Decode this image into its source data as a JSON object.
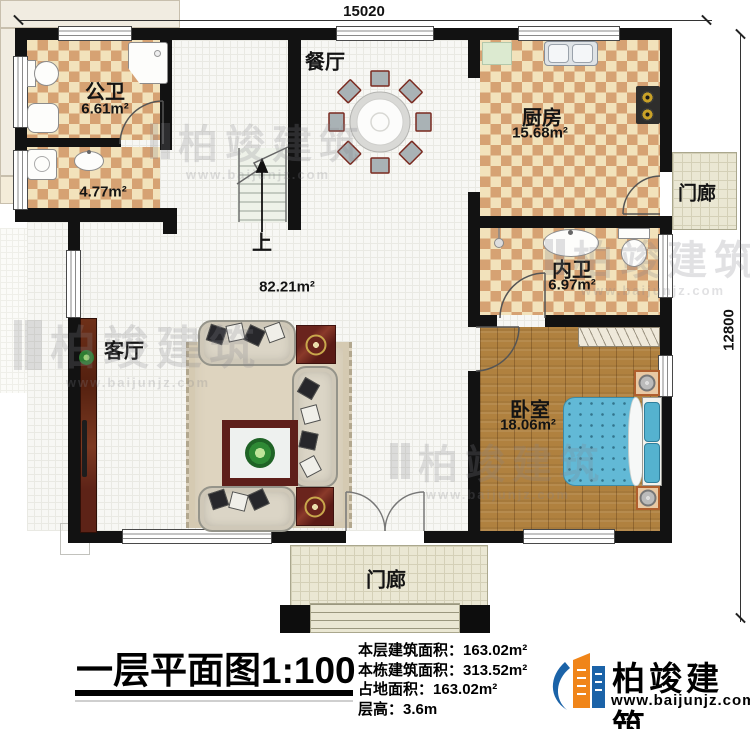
{
  "plan": {
    "dimensions": {
      "width_mm": "15020",
      "height_mm": "12800"
    },
    "rooms": {
      "public_bath": {
        "name": "公卫",
        "area": "6.61m²"
      },
      "laundry": {
        "area": "4.77m²"
      },
      "dining": {
        "name": "餐厅"
      },
      "kitchen": {
        "name": "厨房",
        "area": "15.68m²"
      },
      "porch_right": {
        "name": "门廊"
      },
      "ensuite": {
        "name": "内卫",
        "area": "6.97m²"
      },
      "bedroom": {
        "name": "卧室",
        "area": "18.06m²"
      },
      "living": {
        "name": "客厅",
        "area": "82.21m²"
      },
      "porch_bottom": {
        "name": "门廊"
      },
      "stairs": {
        "up": "上"
      }
    }
  },
  "caption": {
    "title": "一层平面图",
    "scale": "1:100",
    "stats": [
      {
        "label": "本层建筑面积：",
        "value": "163.02m²"
      },
      {
        "label": "本栋建筑面积：",
        "value": "313.52m²"
      },
      {
        "label": "占地面积：",
        "value": "163.02m²"
      },
      {
        "label": "层高：",
        "value": "3.6m"
      }
    ],
    "logo": {
      "name": "柏竣建筑",
      "website": "www.baijunjz.com"
    }
  },
  "watermark": {
    "brand": "柏竣建筑",
    "website": "www.baijunjz.com"
  },
  "colors": {
    "wall": "#121212",
    "tile_light": "#f2e2bb",
    "tile_dark": "#d6a273",
    "wood_floor": "#b0813f",
    "bed": "#62b9d6",
    "dark_wood": "#5e1f1a",
    "porch_tile": "#eae7d3",
    "logo_blue": "#1b63a8",
    "logo_orange": "#f08519"
  }
}
